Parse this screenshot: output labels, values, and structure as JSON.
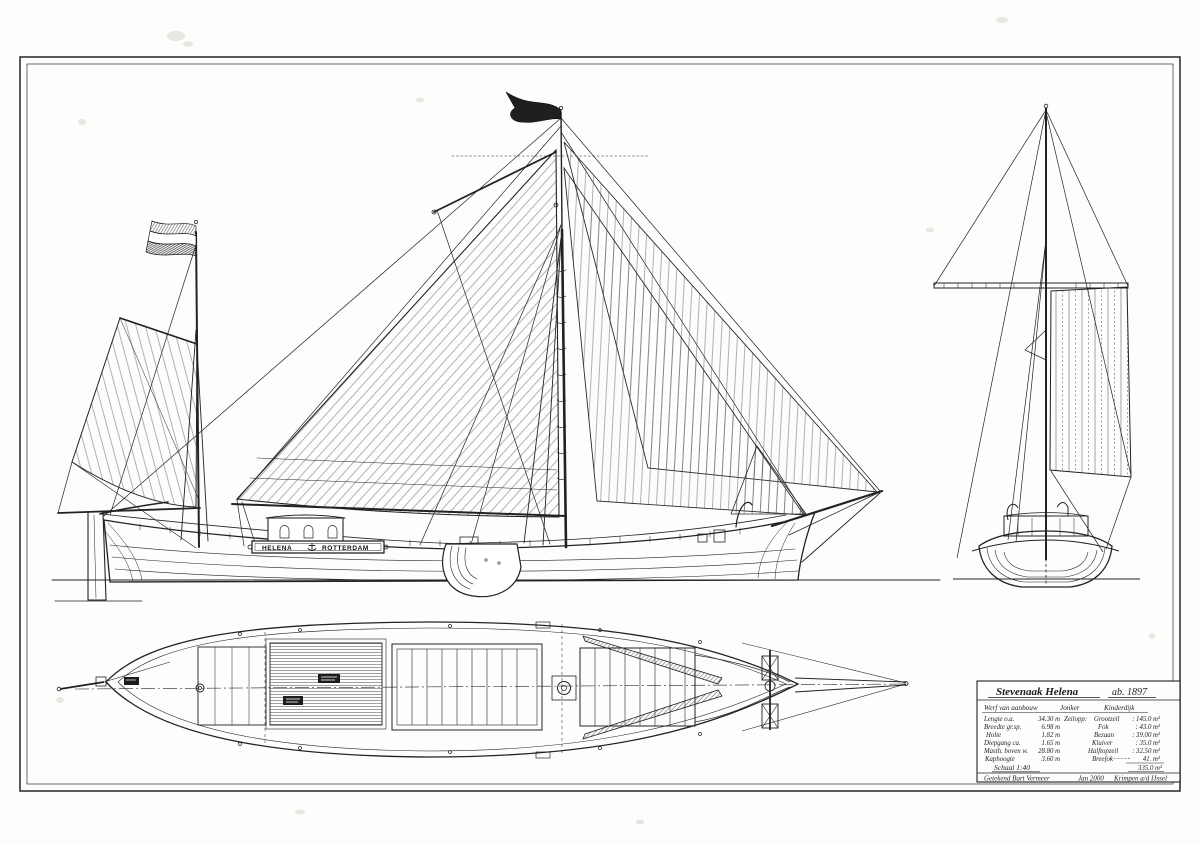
{
  "drawing": {
    "kind": "ship lines and sail plan",
    "ink_color": "#222222",
    "paper_color": "#fdfdfc"
  },
  "ship": {
    "board": {
      "name": "HELENA",
      "port": "ROTTERDAM"
    }
  },
  "title_block": {
    "title": "Stevenaak  Helena",
    "year": "ab. 1897",
    "builder_label": "Werf van aanbouw",
    "builder": "Jonker",
    "builder_place": "Kinderdijk",
    "dims": [
      {
        "label": "Lengte o.a.",
        "value": "34.30 m"
      },
      {
        "label": "Breedte gr.sp.",
        "value": "6.98 m"
      },
      {
        "label": "Holte",
        "value": "1.82 m"
      },
      {
        "label": "Diepgang ca.",
        "value": "1.65 m"
      },
      {
        "label": "Masth. boven w.",
        "value": "28.80 m"
      },
      {
        "label": "Kaphoogte",
        "value": "3.60 m"
      }
    ],
    "sails_header": "Zeilopp:",
    "sails": [
      {
        "label": "Grootzeil",
        "value": ": 145.0 m²"
      },
      {
        "label": "Fok",
        "value": ": 43.0 m²"
      },
      {
        "label": "Bezaan",
        "value": ": 39.00 m²"
      },
      {
        "label": "Kluiver",
        "value": ": 35.0 m²"
      },
      {
        "label": "Halftopzeil",
        "value": ": 32.50 m²"
      },
      {
        "label": "Breefok",
        "value": "41. m²"
      }
    ],
    "sails_total": "335.0 m²",
    "scale": "Schaal 1:40",
    "signature": {
      "drawn_by": "Getekend  Bart Vermeer",
      "date": "Jan 2000",
      "place": "Krimpen a/d IJssel"
    }
  }
}
